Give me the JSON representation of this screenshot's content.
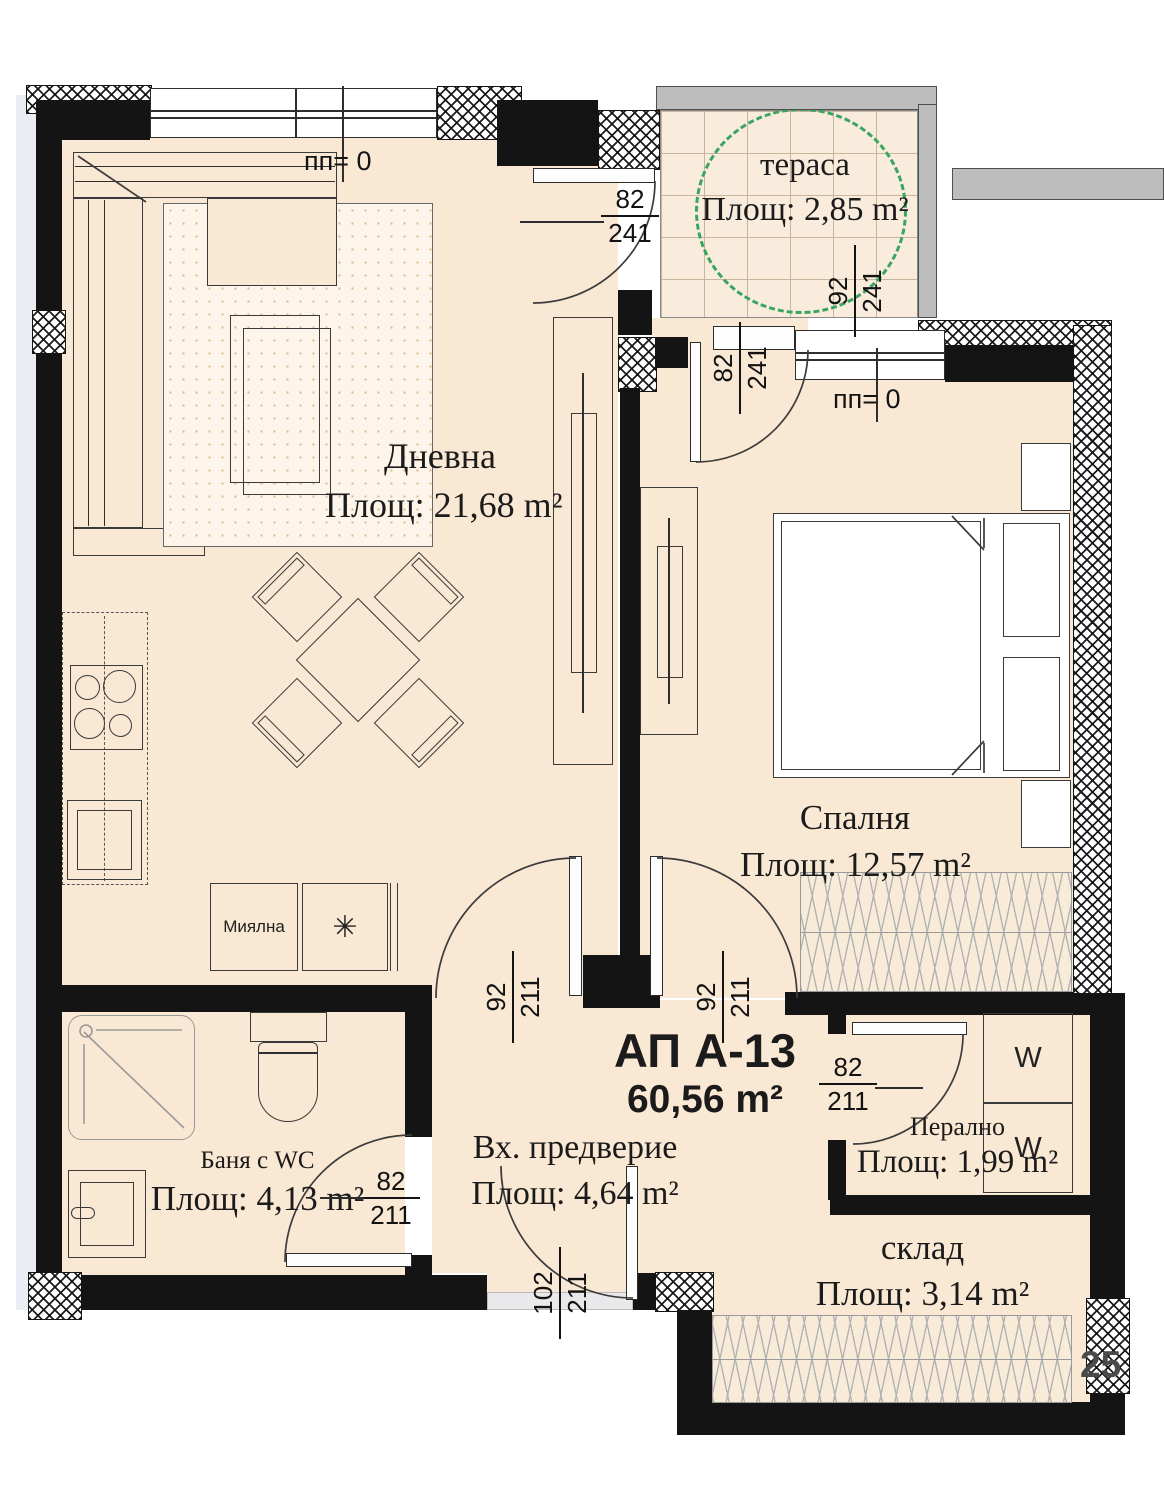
{
  "plan": {
    "apartment": {
      "title": "АП А-13",
      "area": "60,56 m²"
    },
    "rooms": {
      "living": {
        "name": "Дневна",
        "area": "Площ: 21,68 m²"
      },
      "terrace": {
        "name": "тераса",
        "area": "Площ: 2,85 m²"
      },
      "bedroom": {
        "name": "Спалня",
        "area": "Площ: 12,57 m²"
      },
      "bathroom": {
        "name": "Баня с WC",
        "area": "Площ: 4,13 m²"
      },
      "hall": {
        "name": "Вх. предверие",
        "area": "Площ: 4,64 m²"
      },
      "laundry": {
        "name": "Перално",
        "area": "Площ: 1,99 m²"
      },
      "storage": {
        "name": "склад",
        "area": "Площ: 3,14 m²"
      }
    },
    "marks": {
      "level1": "пп= 0",
      "level2": "пп= 0",
      "corner": "25"
    },
    "appliances": {
      "dishwasher": "Миялна",
      "washer_top": "W",
      "washer_bottom": "W",
      "sink_symbol": "✳"
    },
    "dims": {
      "living_terrace_door": {
        "top": "82",
        "bottom": "241"
      },
      "terrace_opening": {
        "top": "92",
        "bottom": "241"
      },
      "bedroom_balcony_door": {
        "top": "82",
        "bottom": "241"
      },
      "living_hall_door": {
        "top": "92",
        "bottom": "211"
      },
      "bedroom_hall_door": {
        "top": "92",
        "bottom": "211"
      },
      "laundry_door": {
        "top": "82",
        "bottom": "211"
      },
      "bathroom_door": {
        "top": "82",
        "bottom": "211"
      },
      "entry_door": {
        "top": "102",
        "bottom": "211"
      }
    },
    "colors": {
      "floor": "#f9e8d3",
      "wall": "#141414",
      "parapet": "#bdbdbd",
      "accent_green": "#3aa561"
    }
  }
}
